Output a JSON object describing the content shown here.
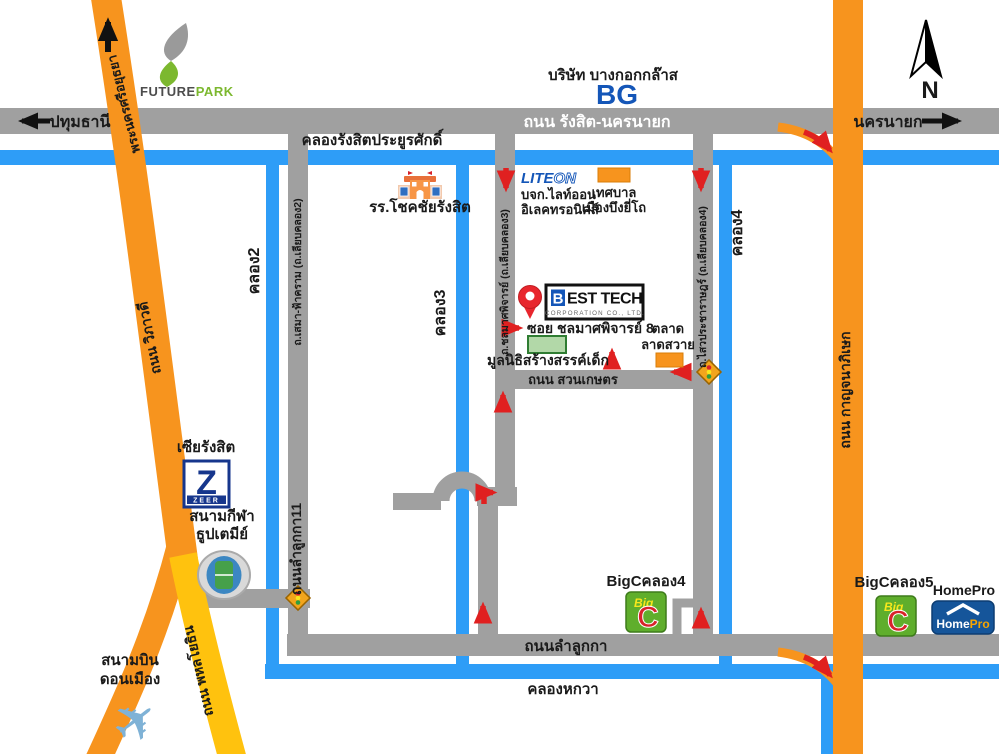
{
  "compass": {
    "n": "N"
  },
  "icons": {
    "plane": "✈"
  },
  "colors": {
    "road_gray": "#a0a0a0",
    "canal_blue": "#2e9df7",
    "highway_orange": "#f7941e",
    "highway_yellow": "#ffc20e",
    "arrow_red": "#e02020",
    "brand_blue": "#1456b8",
    "bigc_green": "#5fae2c",
    "bigc_red": "#d8232a",
    "homepro_blue": "#15559a",
    "zeer_blue": "#16368c",
    "futurepark_green": "#7cb82f"
  },
  "roads": {
    "rangsit": "ถนน รังสิต-นครนายก",
    "pathumthani": "ปทุมธานี",
    "nakhonnayok": "นครนายก",
    "ayutthaya": "พระนครศรีอยุธยา",
    "vibhavadi": "ถนน วิภาวดี",
    "phahonyothin": "ถนน พหลโยธิน",
    "kanchanaphisek": "ถนน กาญจนาภิเษก",
    "lamlukka": "ถนนลำลูกกา",
    "lamlukka11": "ถนนลำลูกกา11",
    "suankaset": "ถนน สวนเกษตร",
    "soi8": "ซอย ชลมาศพิจารย์ 8",
    "sema": "ถ.เสมา-ฟ้าคราม (ถ.เลียบคลอง2)",
    "chonlamat": "ถ.ชลมาศพิจารย์ (ถ.เลียบคลอง3)",
    "sawai": "ถ.ไสวประชาราษฎร์ (ถ.เลียบคลอง4)"
  },
  "canals": {
    "rangsit": "คลองรังสิตประยูรศักดิ์",
    "k2": "คลอง2",
    "k3": "คลอง3",
    "k4": "คลอง4",
    "hokwa": "คลองหกวา"
  },
  "places": {
    "bg_name": "บริษัท บางกอกกล๊าส",
    "school": "รร.โชคชัยรังสิต",
    "liteon1": "บจก.ไลท์ออน",
    "liteon2": "อิเลคทรอนิคส์",
    "mun1": "เทศบาล",
    "mun2": "เมืองบึงยี่โถ",
    "besttech_sub": "CORPORATION CO., LTD.",
    "foundation": "มูลนิธิสร้างสรรค์เด็ก",
    "market1": "ตลาด",
    "market2": "ลาดสวาย",
    "zeer_name": "เซียรังสิต",
    "stadium1": "สนามกีฬา",
    "stadium2": "ธูปเตมีย์",
    "airport1": "สนามบิน",
    "airport2": "ดอนเมือง",
    "bigc4": "BigCคลอง4",
    "bigc5": "BigCคลอง5",
    "homepro": "HomePro"
  },
  "logos": {
    "bg": "BG",
    "future": "FUTURE",
    "park": "PARK",
    "lite": "LITE",
    "on": "ON",
    "zeer_z": "Z",
    "zeer": "ZEER",
    "besttech_b": "B",
    "besttech_rest": "EST TECH",
    "big": "Big",
    "c": "C",
    "homepro_home": "Home",
    "homepro_pro": "Pro"
  }
}
